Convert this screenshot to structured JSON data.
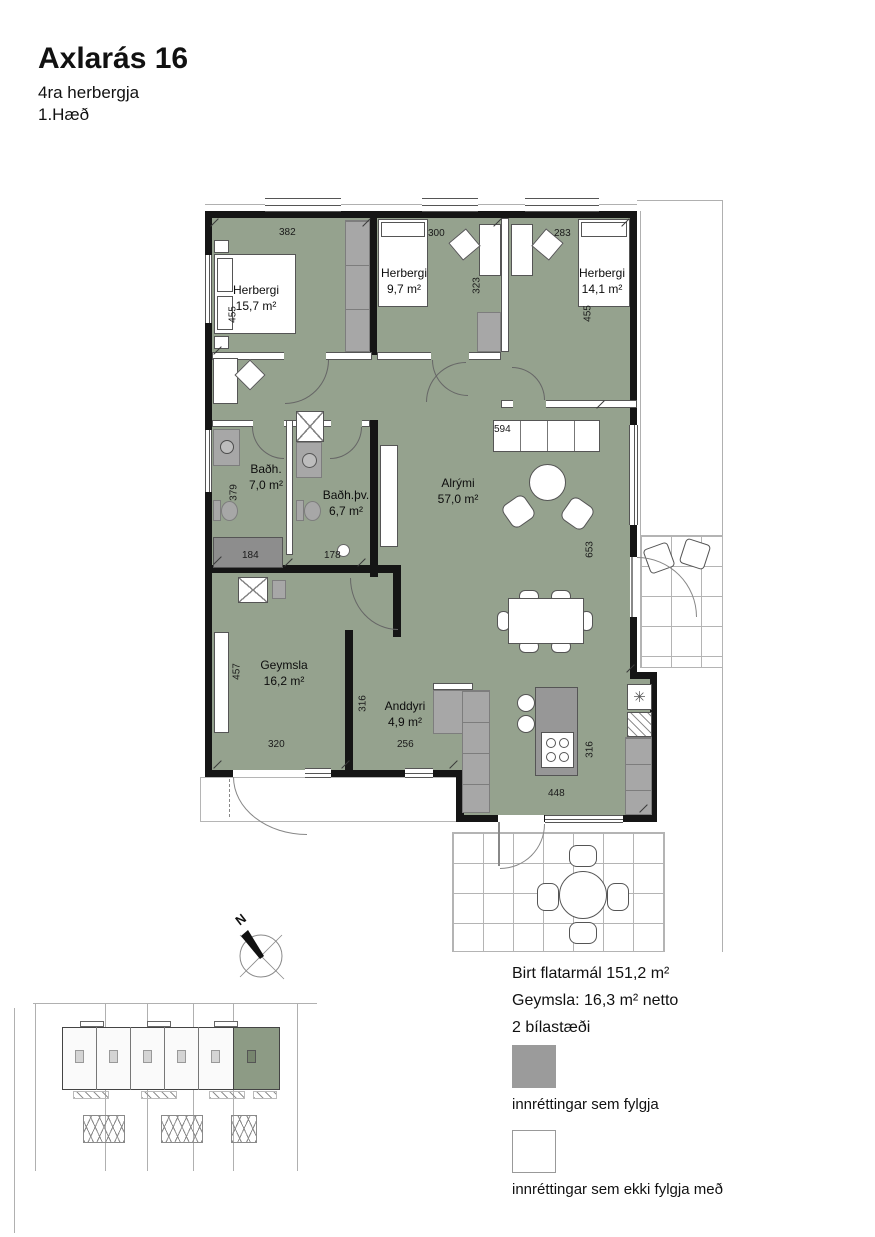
{
  "header": {
    "title": "Axlarás 16",
    "subtitle": "4ra herbergja",
    "floor": "1.Hæð"
  },
  "plan": {
    "rooms": [
      {
        "name": "Herbergi",
        "area": "15,7 m²"
      },
      {
        "name": "Herbergi",
        "area": "9,7 m²"
      },
      {
        "name": "Herbergi",
        "area": "14,1 m²"
      },
      {
        "name": "Baðh.",
        "area": "7,0 m²"
      },
      {
        "name": "Baðh.þv.",
        "area": "6,7 m²"
      },
      {
        "name": "Alrými",
        "area": "57,0 m²"
      },
      {
        "name": "Geymsla",
        "area": "16,2 m²"
      },
      {
        "name": "Anddyri",
        "area": "4,9 m²"
      }
    ],
    "dimensions": [
      "382",
      "300",
      "283",
      "455",
      "323",
      "455",
      "594",
      "379",
      "184",
      "178",
      "653",
      "457",
      "316",
      "320",
      "256",
      "448",
      "316"
    ],
    "compass_label": "N"
  },
  "info": {
    "lines": [
      "Birt flatarmál 151,2 m²",
      "Geymsla: 16,3 m² netto",
      "2 bílastæði"
    ]
  },
  "legend": {
    "items": [
      {
        "label": "innréttingar sem fylgja",
        "swatch_style": "background:#9b9b9b"
      },
      {
        "label": "innréttingar sem ekki fylgja með",
        "swatch_style": "background:#ffffff;border:1px solid #999"
      }
    ]
  },
  "colors": {
    "floor_fill": "#95a28e",
    "fixture_gray": "#a7a7a7",
    "dark_fixture_gray": "#8d8d8d",
    "wall_black": "#151515",
    "site_highlight": "#8d9b85"
  }
}
